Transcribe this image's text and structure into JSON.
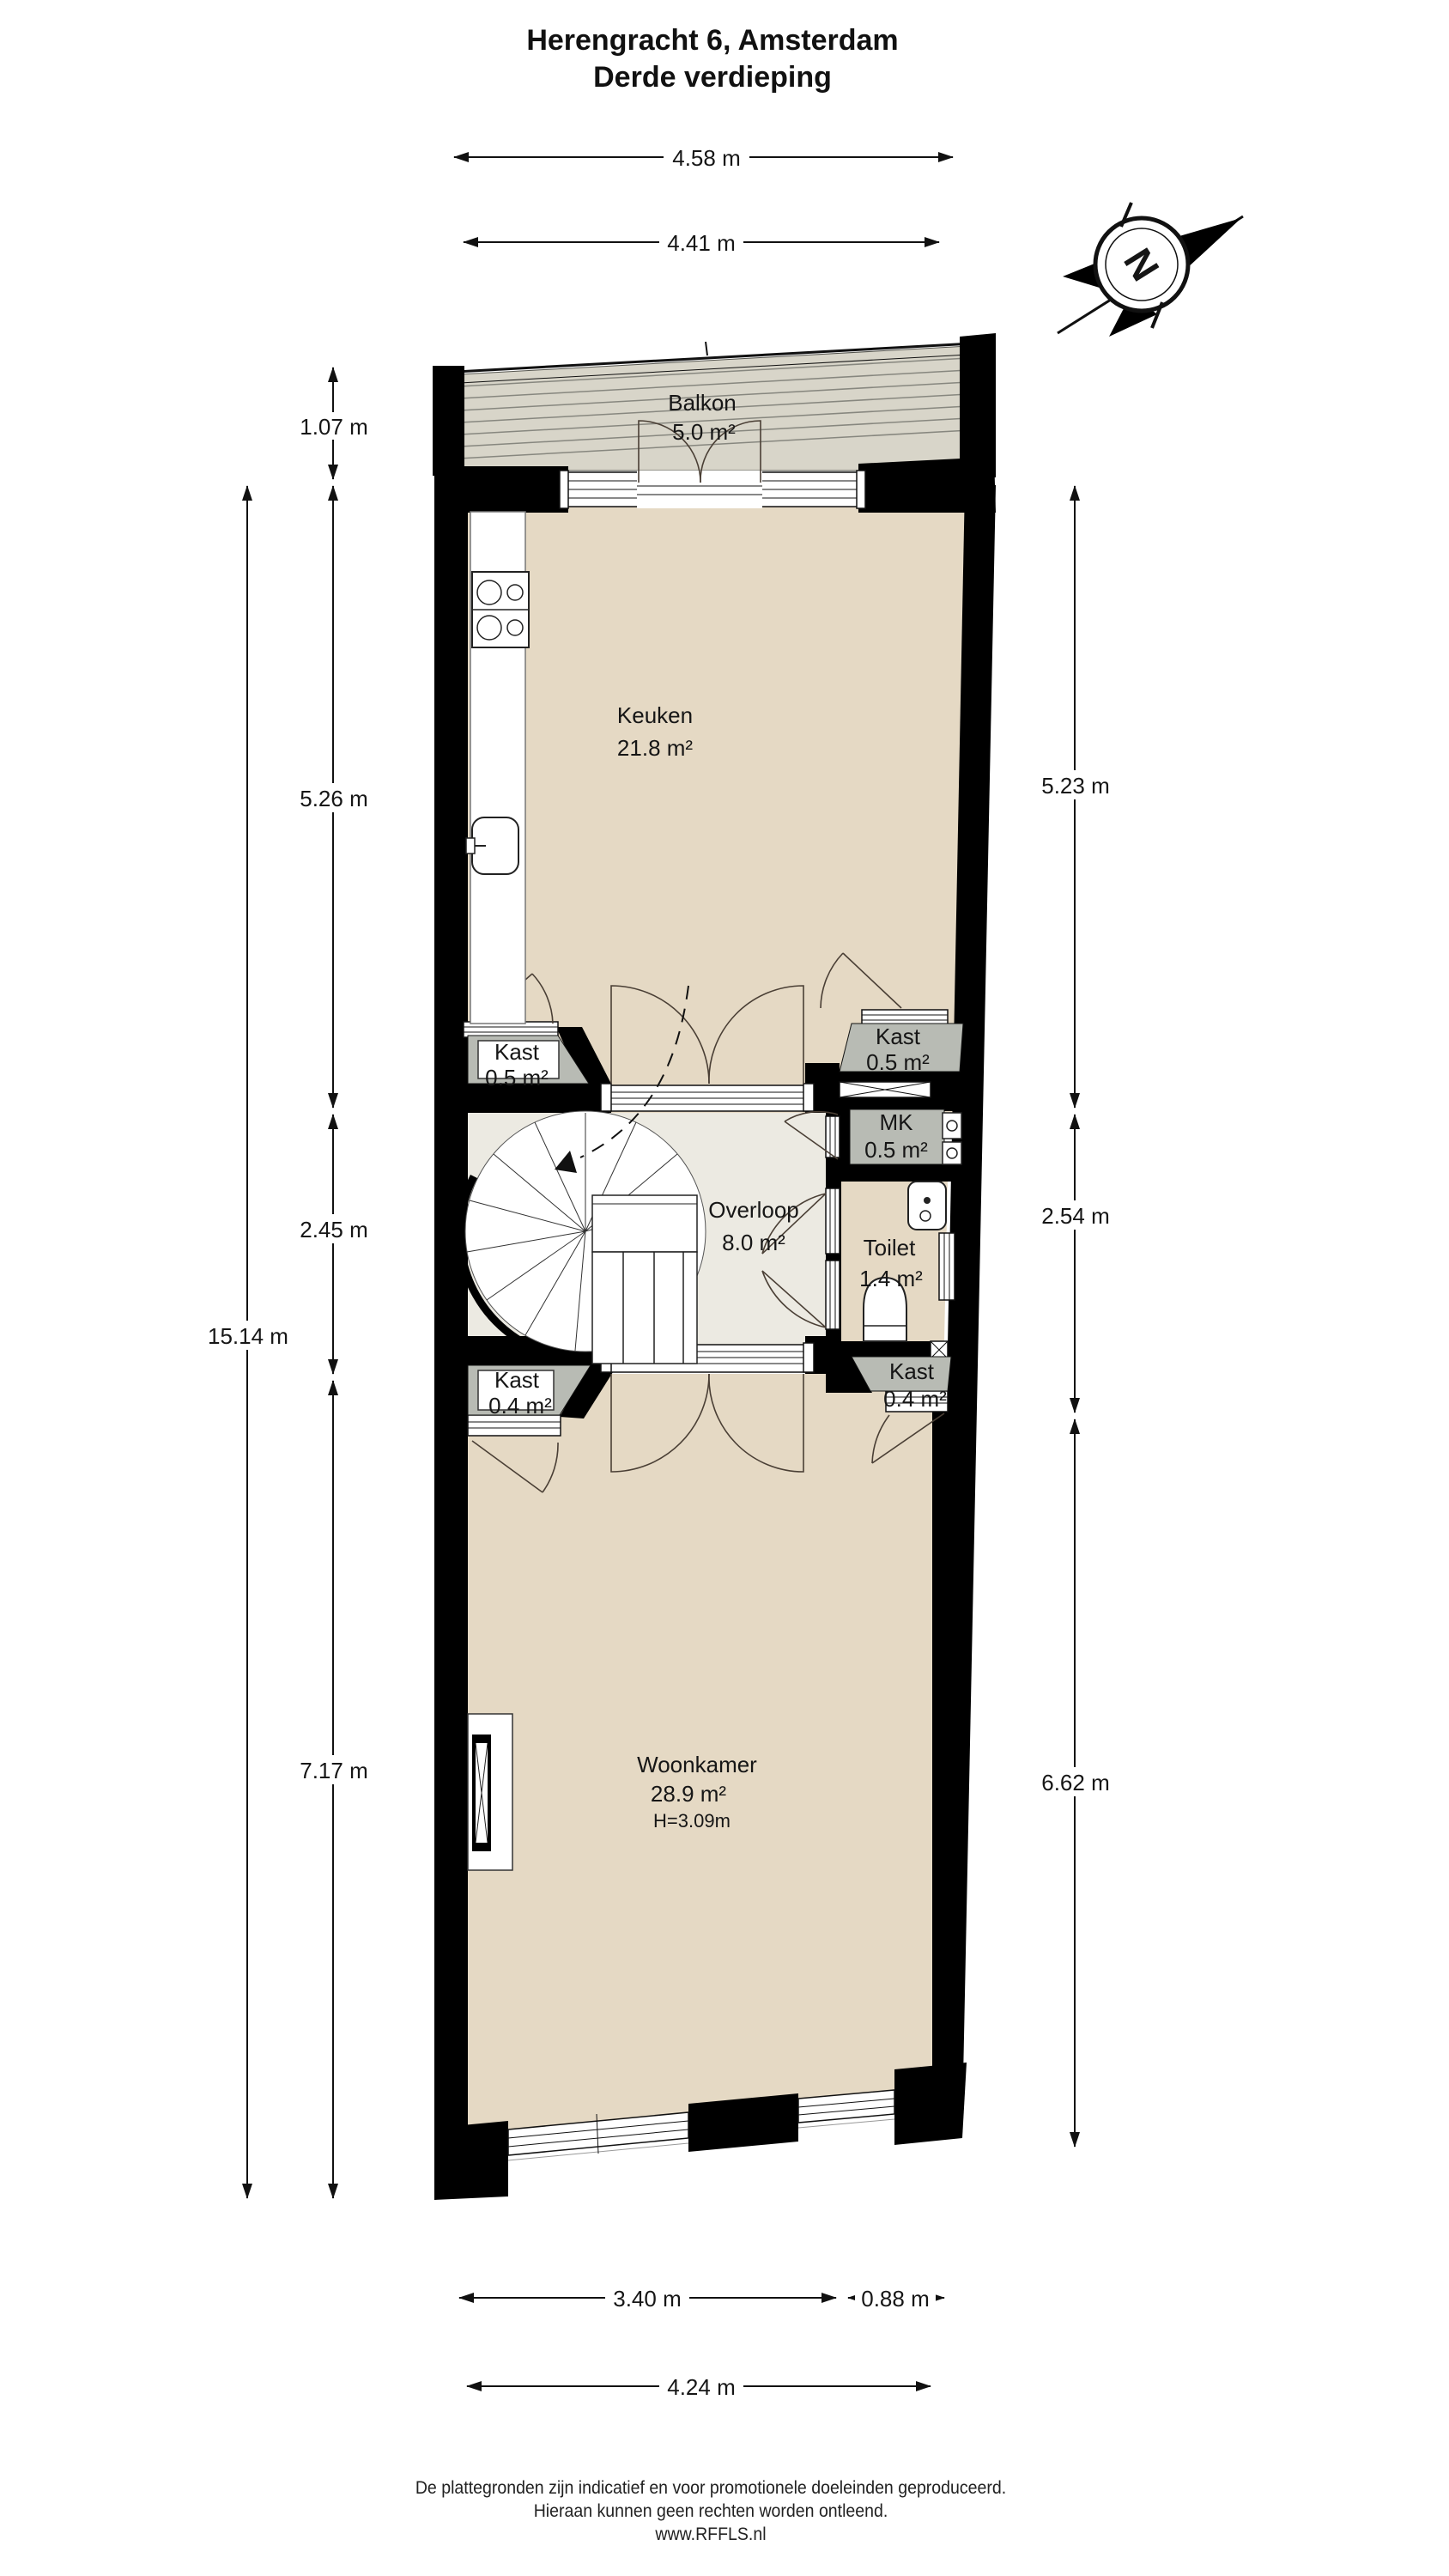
{
  "title": {
    "line1": "Herengracht 6, Amsterdam",
    "line2": "Derde verdieping"
  },
  "compass": {
    "north_label": "N"
  },
  "rooms": {
    "balkon": {
      "name": "Balkon",
      "area": "5.0 m²"
    },
    "keuken": {
      "name": "Keuken",
      "area": "21.8 m²"
    },
    "kast_keuken_links": {
      "name": "Kast",
      "area": "0.5 m²"
    },
    "kast_keuken_rechts": {
      "name": "Kast",
      "area": "0.5 m²"
    },
    "mk": {
      "name": "MK",
      "area": "0.5 m²"
    },
    "overloop": {
      "name": "Overloop",
      "area": "8.0 m²"
    },
    "toilet": {
      "name": "Toilet",
      "area": "1.4 m²"
    },
    "kast_woonkamer_links": {
      "name": "Kast",
      "area": "0.4 m²"
    },
    "kast_woonkamer_rechts": {
      "name": "Kast",
      "area": "0.4 m²"
    },
    "woonkamer": {
      "name": "Woonkamer",
      "area": "28.9 m²",
      "ceiling_height": "H=3.09m"
    }
  },
  "dimensions": {
    "top_outer": "4.58 m",
    "top_inner": "4.41 m",
    "left_balkon": "1.07 m",
    "left_keuken": "5.26 m",
    "left_overloop": "2.45 m",
    "left_woonkamer": "7.17 m",
    "left_total": "15.14 m",
    "right_keuken": "5.23 m",
    "right_overloop": "2.54 m",
    "right_woonkamer": "6.62 m",
    "bottom_window": "3.40 m",
    "bottom_right": "0.88 m",
    "bottom_inner": "4.24 m"
  },
  "footer": {
    "line1": "De plattegronden zijn indicatief en voor promotionele doeleinden geproduceerd.",
    "line2": "Hieraan kunnen geen rechten worden ontleend.",
    "line3": "www.RFFLS.nl"
  },
  "colors": {
    "floor": "#e5d9c4",
    "landing_floor": "#eceae2",
    "closet": "#b8bbb4",
    "balcony": "#d8d5c9",
    "wall": "#000000"
  }
}
